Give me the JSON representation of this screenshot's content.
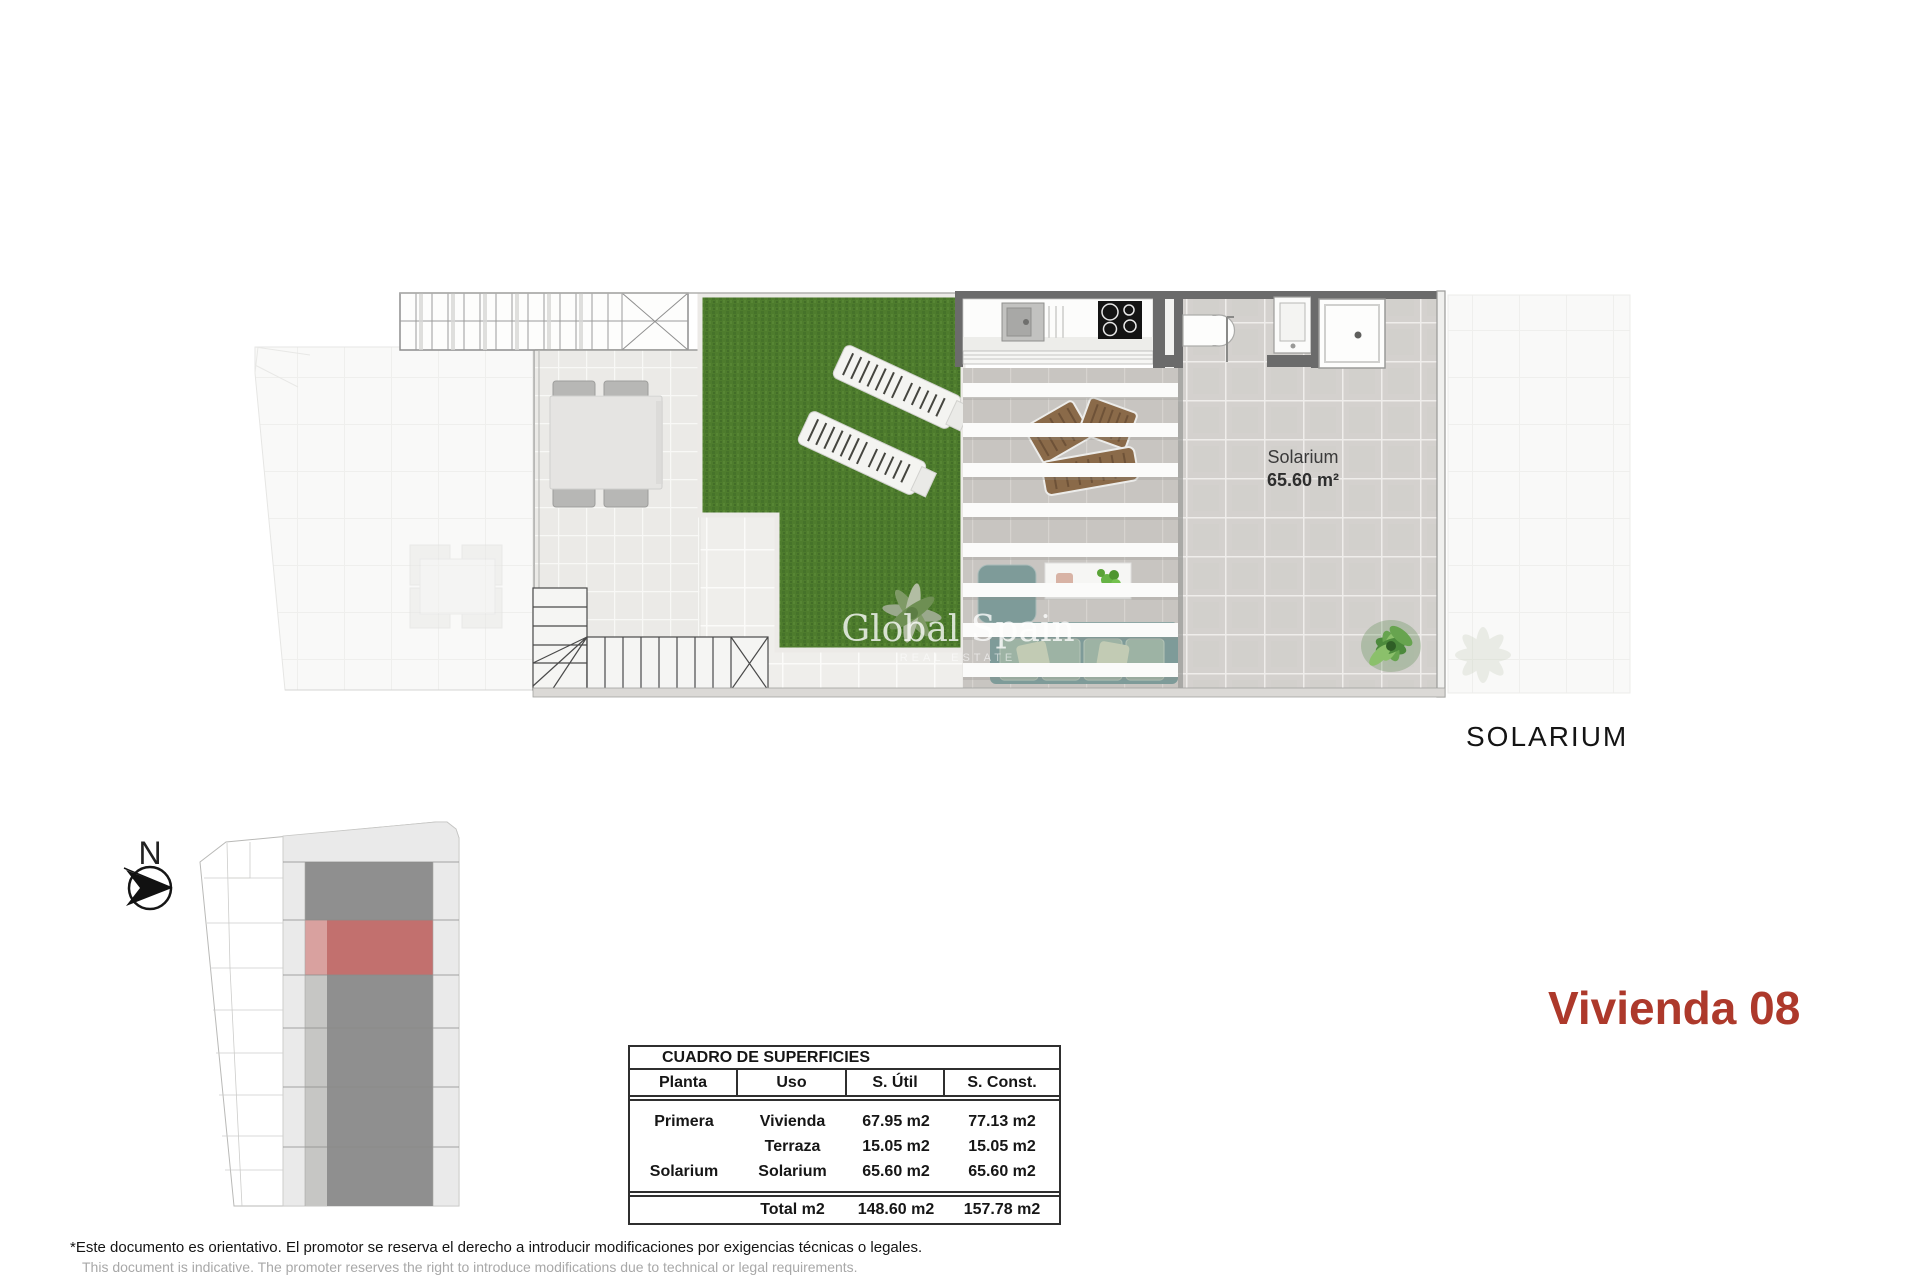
{
  "headings": {
    "solarium": "SOLARIUM",
    "unit": "Vivienda 08"
  },
  "compass": {
    "north_label": "N"
  },
  "plan": {
    "room_label": "Solarium",
    "room_area": "65.60 m²",
    "watermark_line1": "Global Spain",
    "watermark_line2": "REAL ESTATE"
  },
  "table": {
    "title": "CUADRO DE SUPERFICIES",
    "columns": [
      "Planta",
      "Uso",
      "S. Útil",
      "S. Const."
    ],
    "rows": [
      {
        "planta": "Primera",
        "uso": "Vivienda",
        "util": "67.95 m2",
        "konst": "77.13 m2"
      },
      {
        "planta": "",
        "uso": "Terraza",
        "util": "15.05 m2",
        "konst": "15.05 m2"
      },
      {
        "planta": "Solarium",
        "uso": "Solarium",
        "util": "65.60 m2",
        "konst": "65.60 m2"
      }
    ],
    "total": {
      "planta": "",
      "label": "Total m2",
      "util": "148.60 m2",
      "konst": "157.78 m2"
    }
  },
  "disclaimer": {
    "es": "*Este documento es orientativo. El promotor se reserva el derecho a introducir modificaciones por exigencias técnicas o legales.",
    "en": "This document is indicative. The promoter reserves the right to introduce modifications due to technical or legal requirements."
  },
  "colors": {
    "accent_red": "#ad392b",
    "site_highlight": "#c2706e",
    "building_dark": "#8f8f8f",
    "grass_green": "#4e7c2d",
    "tile_gray": "#d4d1ce",
    "wall_dark": "#6b6b6b"
  }
}
